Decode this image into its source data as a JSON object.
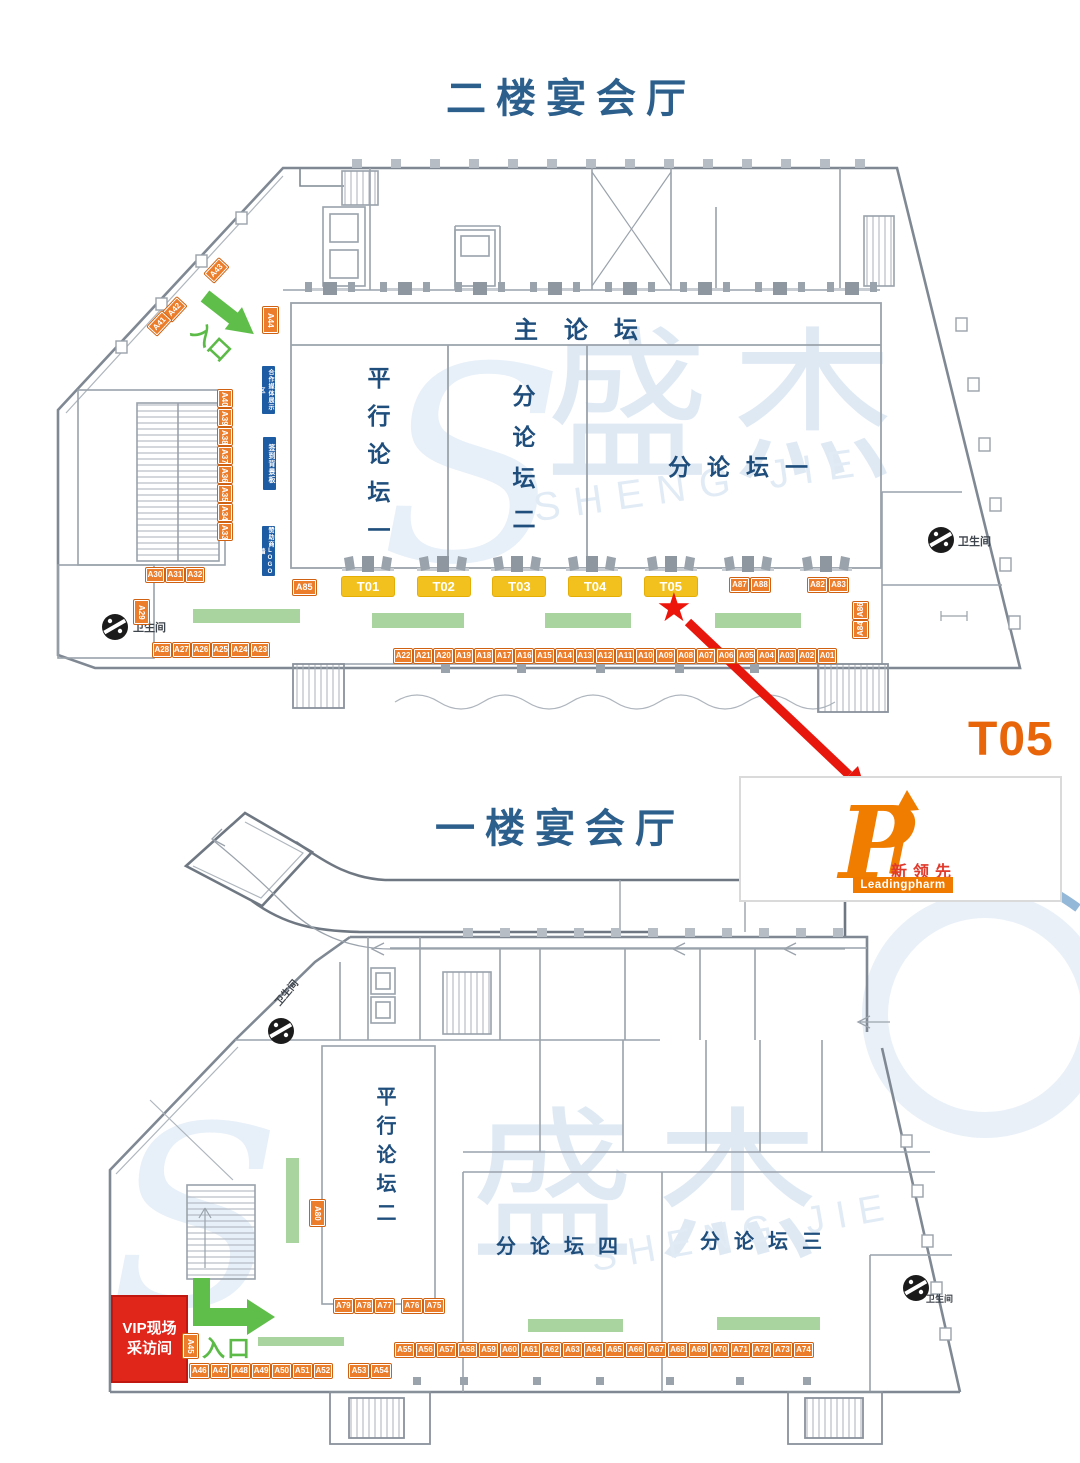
{
  "floor2": {
    "title": "二楼宴会厅",
    "main_forum": "主论坛",
    "parallel_forum_1": "平行论坛一",
    "sub_forum_2": "分论坛二",
    "sub_forum_1": "分论坛一",
    "entrance": "入口",
    "restroom": "卫生间",
    "boards": [
      "合作媒体展示区",
      "签到背景板",
      "赞助商LOGO墙"
    ],
    "t_booths": [
      "T01",
      "T02",
      "T03",
      "T04",
      "T05"
    ],
    "booths": {
      "a43": "A43",
      "a42": "A42",
      "a41": "A41",
      "a44": "A44",
      "row_a30_a32": [
        "A30",
        "A31",
        "A32"
      ],
      "col_a40_a33": [
        "A40",
        "A39",
        "A38",
        "A37",
        "A36",
        "A35",
        "A34",
        "A33"
      ],
      "a29": "A29",
      "row_a28_a23": [
        "A28",
        "A27",
        "A26",
        "A25",
        "A24",
        "A23"
      ],
      "a85": "A85",
      "row_a87_a88": [
        "A87",
        "A88"
      ],
      "row_a82_a83": [
        "A82",
        "A83"
      ],
      "a86": "A86",
      "a84": "A84",
      "row_a22_a01": [
        "A22",
        "A21",
        "A20",
        "A19",
        "A18",
        "A17",
        "A16",
        "A15",
        "A14",
        "A13",
        "A12",
        "A11",
        "A10",
        "A09",
        "A08",
        "A07",
        "A06",
        "A05",
        "A04",
        "A03",
        "A02",
        "A01"
      ]
    }
  },
  "callout": {
    "label": "T05",
    "brand_cn": "新领先",
    "brand_en": "Leadingpharm"
  },
  "floor1": {
    "title": "一楼宴会厅",
    "parallel_forum_2": "平行论坛二",
    "sub_forum_4": "分论坛四",
    "sub_forum_3": "分论坛三",
    "entrance": "入口",
    "restroom": "卫生间",
    "vip_room": [
      "VIP现场",
      "采访间"
    ],
    "booths": {
      "a45": "A45",
      "a80": "A80",
      "row_a79_a77": [
        "A79",
        "A78",
        "A77"
      ],
      "row_a76_a75": [
        "A76",
        "A75"
      ],
      "row_a46_a52": [
        "A46",
        "A47",
        "A48",
        "A49",
        "A50",
        "A51",
        "A52"
      ],
      "row_a53_a54": [
        "A53",
        "A54"
      ],
      "row_a55_a74": [
        "A55",
        "A56",
        "A57",
        "A58",
        "A59",
        "A60",
        "A61",
        "A62",
        "A63",
        "A64",
        "A65",
        "A66",
        "A67",
        "A68",
        "A69",
        "A70",
        "A71",
        "A72",
        "A73",
        "A74"
      ]
    }
  },
  "watermark": {
    "logo": "S",
    "cn": "盛杰",
    "en": "SHENG JIE"
  }
}
